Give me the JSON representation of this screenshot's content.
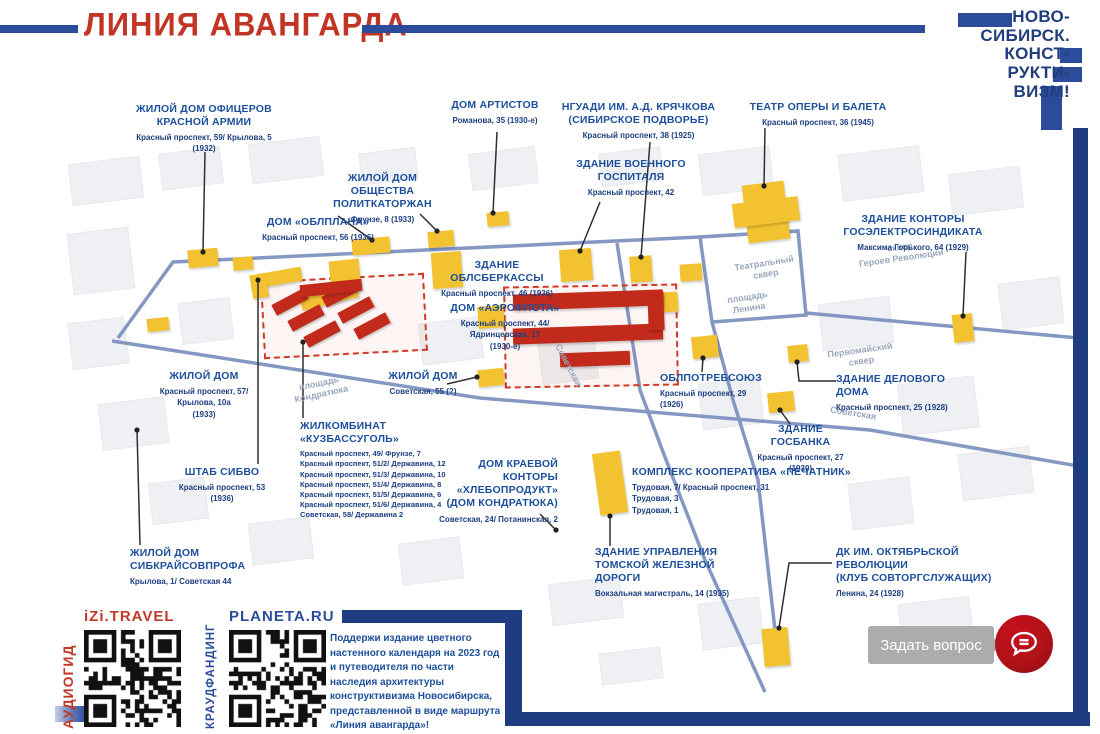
{
  "header": {
    "title": "ЛИНИЯ АВАНГАРДА",
    "logo_lines": [
      "НОВО-",
      "СИБИРСК.",
      "КОНСТ-",
      "РУКТИ-",
      "ВИЗМ!"
    ]
  },
  "colors": {
    "title_red": "#c23526",
    "label_blue": "#1d4f9a",
    "frame_navy": "#1e3c80",
    "route_blue": "#7e93c0",
    "building_yellow": "#f2c230",
    "building_red": "#c22b1b",
    "ask_button_red": "#b01218"
  },
  "map": {
    "places": [
      {
        "label": "Театральный\nсквер"
      },
      {
        "label": "площадь\nЛенина"
      },
      {
        "label": "площадь\nКондратюка"
      },
      {
        "label": "Советская"
      },
      {
        "label": "Советская"
      },
      {
        "label": "сквер\nГероев Революции"
      },
      {
        "label": "Первомайский\nсквер"
      }
    ]
  },
  "landmarks": [
    {
      "name": "ЖИЛОЙ ДОМ ОФИЦЕРОВ\nКРАСНОЙ АРМИИ",
      "address": "Красный проспект, 59/ Крылова, 5\n(1932)"
    },
    {
      "name": "ДОМ «ОБЛПЛАНА»",
      "address": "Красный проспект, 56 (1936)"
    },
    {
      "name": "ЖИЛОЙ ДОМ\nОБЩЕСТВА ПОЛИТКАТОРЖАН",
      "address": "Фрунзе, 8 (1933)"
    },
    {
      "name": "ДОМ АРТИСТОВ",
      "address": "Романова, 35 (1930-е)"
    },
    {
      "name": "ЗДАНИЕ ОБЛСБЕРКАССЫ",
      "address": "Красный проспект, 46 (1936)"
    },
    {
      "name": "ДОМ «АЭРОФЛОТА»",
      "address": "Красный проспект, 44/\nЯдринцевская, 17\n(1930-е)"
    },
    {
      "name": "ЗДАНИЕ ВОЕННОГО\nГОСПИТАЛЯ",
      "address": "Красный проспект, 42"
    },
    {
      "name": "НГУАДИ ИМ. А.Д. КРЯЧКОВА\n(СИБИРСКОЕ ПОДВОРЬЕ)",
      "address": "Красный проспект, 38 (1925)"
    },
    {
      "name": "ТЕАТР ОПЕРЫ И БАЛЕТА",
      "address": "Красный проспект, 36 (1945)"
    },
    {
      "name": "ЗДАНИЕ КОНТОРЫ\nГОСЭЛЕКТРОСИНДИКАТА",
      "address": "Максима Горького, 64 (1929)"
    },
    {
      "name": "ЖИЛОЙ ДОМ",
      "address": "Красный проспект, 57/\nКрылова, 10а\n(1933)"
    },
    {
      "name": "ЖИЛОЙ ДОМ",
      "address": "Советская, 55 (?)"
    },
    {
      "name": "ЖИЛКОМБИНАТ «КУЗБАССУГОЛЬ»",
      "address": "Красный проспект, 49/ Фрунзе, 7\nКрасный проспект, 51/2/ Державина, 12\nКрасный проспект, 51/3/ Державина, 10\nКрасный проспект, 51/4/ Державина, 8\nКрасный проспект, 51/5/ Державина, 6\nКрасный проспект, 51/6/ Державина, 4\nСоветская, 58/ Державина 2"
    },
    {
      "name": "ШТАБ СИБВО",
      "address": "Красный проспект, 53 (1936)"
    },
    {
      "name": "ДОМ КРАЕВОЙ КОНТОРЫ\n«ХЛЕБОПРОДУКТ»\n(ДОМ КОНДРАТЮКА)",
      "address": "Советская, 24/ Потанинская, 2"
    },
    {
      "name": "ОБЛПОТРЕБСОЮЗ",
      "address": "Красный проспект, 29 (1926)"
    },
    {
      "name": "ЗДАНИЕ ДЕЛОВОГО ДОМА",
      "address": "Красный проспект, 25 (1928)"
    },
    {
      "name": "ЗДАНИЕ ГОСБАНКА",
      "address": "Красный проспект, 27 (1930)"
    },
    {
      "name": "КОМПЛЕКС КООПЕРАТИВА «ПЕЧАТНИК»",
      "address": "Трудовая, 7/ Красный проспект, 31\nТрудовая, 3\nТрудовая, 1"
    },
    {
      "name": "ЖИЛОЙ ДОМ СИБКРАЙСОВПРОФА",
      "address": "Крылова, 1/ Советская 44"
    },
    {
      "name": "ЗДАНИЕ УПРАВЛЕНИЯ\nТОМСКОЙ ЖЕЛЕЗНОЙ ДОРОГИ",
      "address": "Вокзальная магистраль, 14 (1935)"
    },
    {
      "name": "ДК ИМ. ОКТЯБРЬСКОЙ РЕВОЛЮЦИИ\n(КЛУБ СОВТОРГСЛУЖАЩИХ)",
      "address": "Ленина, 24 (1928)"
    }
  ],
  "footer": {
    "qr_blocks": [
      {
        "vertical": "АУДИОГИД",
        "site": "iZi.TRAVEL"
      },
      {
        "vertical": "КРАУДФАНДИНГ",
        "site": "PLANETA.RU"
      }
    ],
    "support_text": "Поддержи издание цветного настенного календаря на 2023 год и путеводителя по части наследия архитектуры конструктивизма Новосибирска, представленной в виде маршрута «Линия авангарда»!",
    "ask_label": "Задать вопрос"
  }
}
